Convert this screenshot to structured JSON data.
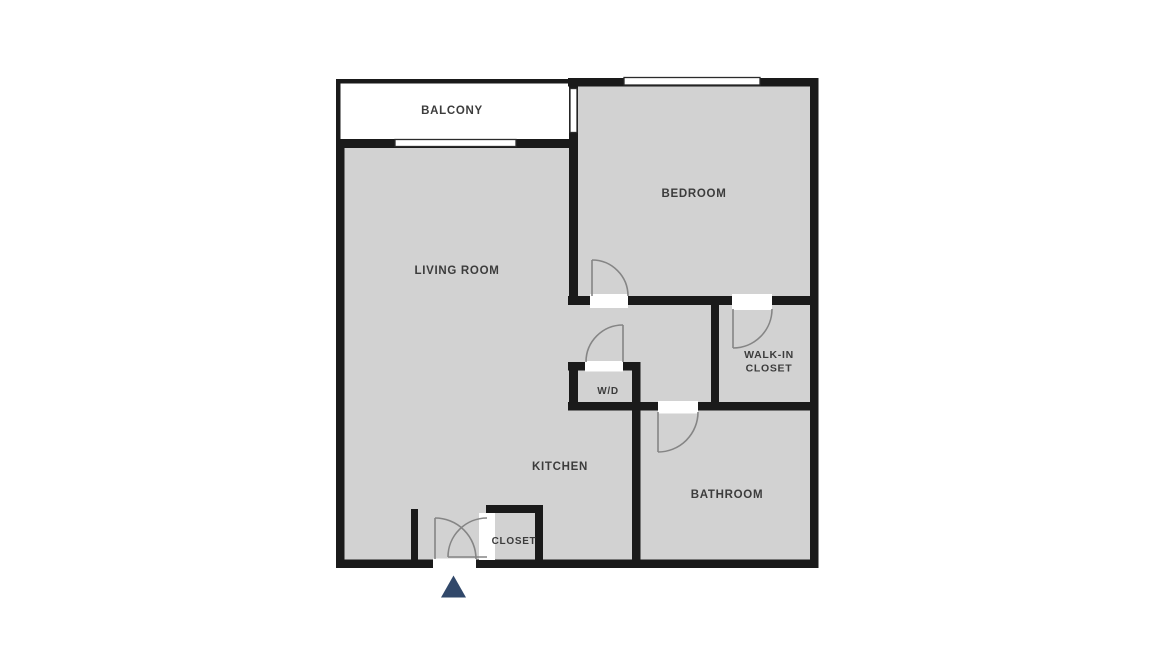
{
  "floorplan": {
    "rooms": {
      "balcony": {
        "label": "BALCONY"
      },
      "bedroom": {
        "label": "BEDROOM"
      },
      "living_room": {
        "label": "LIVING ROOM"
      },
      "walk_in_closet": {
        "line1": "WALK-IN",
        "line2": "CLOSET"
      },
      "wd": {
        "label": "W/D"
      },
      "kitchen": {
        "label": "KITCHEN"
      },
      "bathroom": {
        "label": "BATHROOM"
      },
      "closet": {
        "label": "CLOSET"
      }
    },
    "icons": {
      "entry_marker": "filled-triangle-up"
    },
    "colors": {
      "page_bg": "#ffffff",
      "floor": "#d2d2d2",
      "wall": "#1a1a1a",
      "opening": "#ffffff",
      "window_border": "#2b2b2b",
      "door_arc": "#858585",
      "label": "#3c3c3c",
      "entry_marker": "#31486a"
    }
  }
}
